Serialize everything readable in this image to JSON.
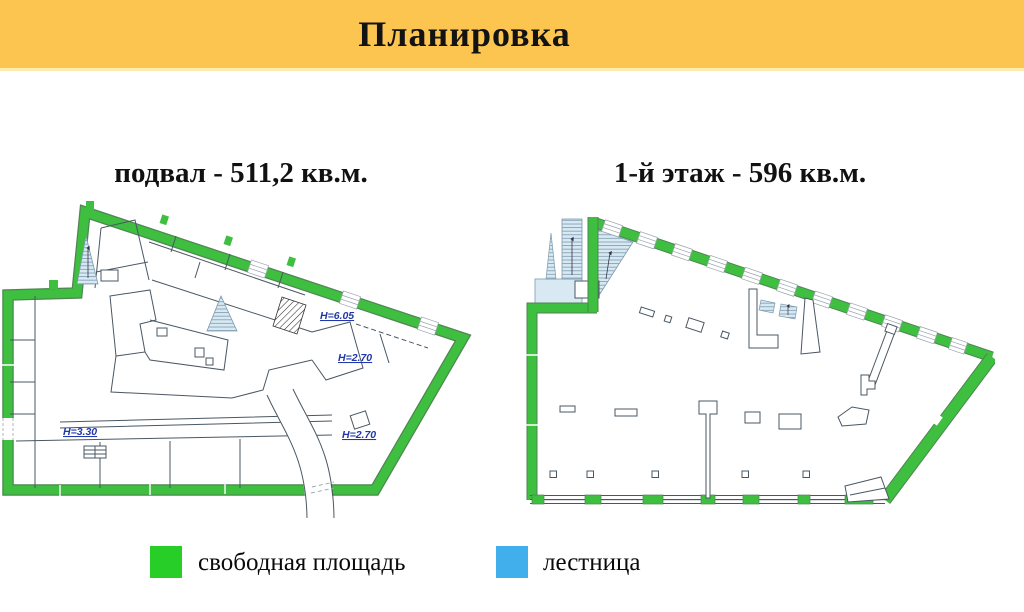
{
  "header": {
    "title": "Планировка"
  },
  "plans": {
    "left": {
      "title": "подвал - 511,2 кв.м.",
      "annotations": [
        {
          "text": "H=6.05"
        },
        {
          "text": "H=2.70"
        },
        {
          "text": "H=3.30"
        },
        {
          "text": "H=2.70"
        }
      ]
    },
    "right": {
      "title": "1-й этаж - 596 кв.м."
    }
  },
  "legend": {
    "items": [
      {
        "label": "свободная площадь",
        "color": "#28CE28"
      },
      {
        "label": "лестница",
        "color": "#41AFEC"
      }
    ]
  },
  "colors": {
    "header_background": "#FCC550",
    "wall_green": "#3FBF3F",
    "stair_fill": "#D8E9F3",
    "interior_line": "#4A5763",
    "annotation_blue": "#2238A8"
  }
}
